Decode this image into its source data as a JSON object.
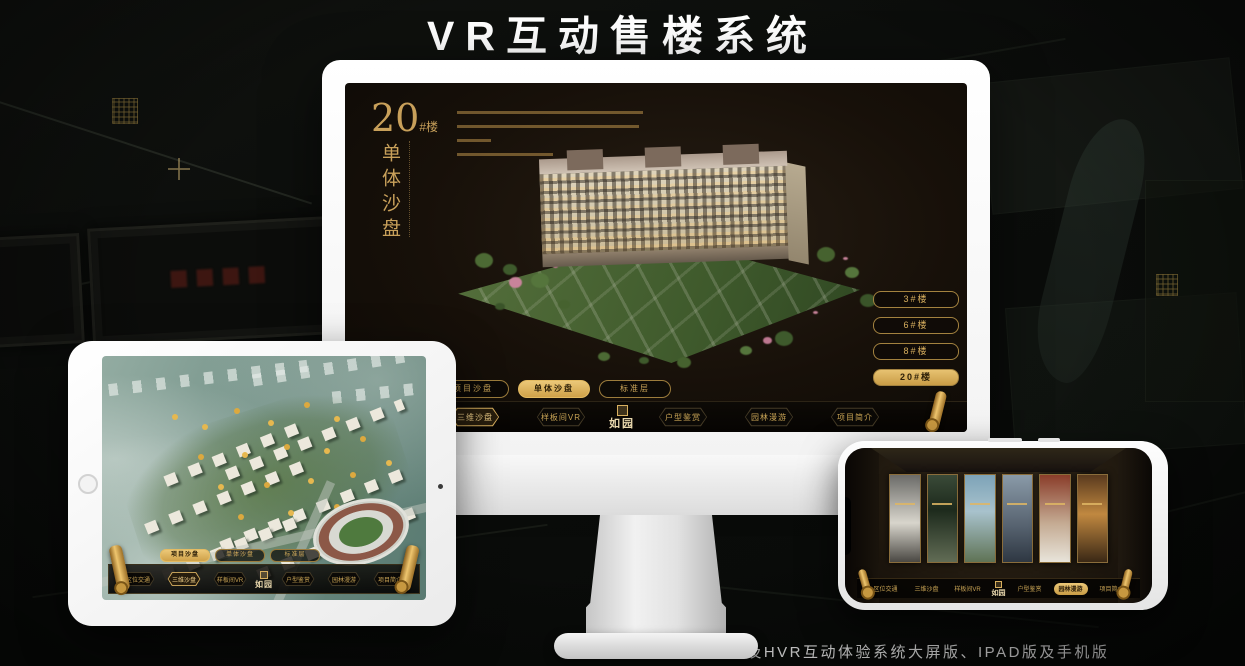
{
  "page": {
    "title": "VR互动售楼系统",
    "footnote": "*本项目涉及HVR互动体验系统大屏版、IPAD版及手机版"
  },
  "colors": {
    "accent_gold": "#D9B05F",
    "highlight_gold": "#ECC878",
    "screen_bg": "#171009"
  },
  "brand": {
    "logo_name": "如园"
  },
  "monitor": {
    "building_label": {
      "number": "20",
      "suffix": "#楼",
      "subtitle": "单体沙盘"
    },
    "floor_buttons": [
      {
        "label": "3#楼"
      },
      {
        "label": "6#楼"
      },
      {
        "label": "8#楼"
      },
      {
        "label": "20#楼",
        "active": true
      }
    ],
    "tabs": [
      {
        "label": "项目沙盘"
      },
      {
        "label": "单体沙盘",
        "active": true
      },
      {
        "label": "标准层"
      }
    ],
    "menu_left": [
      {
        "label": "区位交通"
      },
      {
        "label": "三维沙盘",
        "active": true
      },
      {
        "label": "样板间VR"
      }
    ],
    "menu_right": [
      {
        "label": "户型鉴赏"
      },
      {
        "label": "园林漫游"
      },
      {
        "label": "项目简介"
      }
    ]
  },
  "ipad": {
    "tabs": [
      {
        "label": "项目沙盘",
        "active": true
      },
      {
        "label": "单体沙盘"
      },
      {
        "label": "标准层"
      }
    ],
    "menu_left": [
      {
        "label": "区位交通"
      },
      {
        "label": "三维沙盘",
        "active": true
      },
      {
        "label": "样板间VR"
      }
    ],
    "menu_right": [
      {
        "label": "户型鉴赏"
      },
      {
        "label": "园林漫游"
      },
      {
        "label": "项目简介"
      }
    ]
  },
  "phone": {
    "menu_left": [
      {
        "label": "区位交通"
      },
      {
        "label": "三维沙盘"
      },
      {
        "label": "样板间VR"
      }
    ],
    "menu_right": [
      {
        "label": "户型鉴赏"
      },
      {
        "label": "园林漫游",
        "active": true
      },
      {
        "label": "项目简介"
      }
    ]
  }
}
